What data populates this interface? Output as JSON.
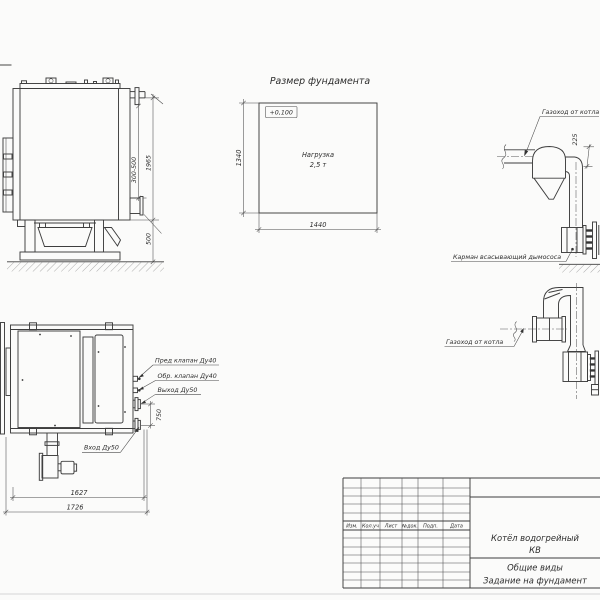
{
  "sheet": {
    "background": "#fbfbfa",
    "line_color": "#3e3e3e",
    "title_block": {
      "columns": [
        "Изм.",
        "Кол.уч",
        "Лист",
        "№док.",
        "Подп.",
        "Дата"
      ],
      "product_line1": "Котёл водогрейный",
      "product_line2": "КВ",
      "doc_line1": "Общие виды",
      "doc_line2": "Задание на фундамент"
    }
  },
  "side_view": {
    "dim_nozzle": "300-500",
    "dim_height": "1965",
    "dim_base": "500"
  },
  "foundation": {
    "title": "Размер фундамента",
    "elevation": "+0,100",
    "load_line1": "Нагрузка",
    "load_line2": "2,5 т",
    "dim_width": "1440",
    "dim_depth": "1340"
  },
  "flue_upper": {
    "label_duct": "Газоход от котла",
    "dim_offset": "225",
    "label_pocket": "Карман всасывающий дымососа"
  },
  "flue_lower": {
    "label_duct": "Газоход от котла"
  },
  "plan_view": {
    "label_safety_valve": "Пред клапан Ду40",
    "label_check_valve": "Обр. клапан Ду40",
    "label_outlet": "Выход Ду50",
    "label_inlet": "Вход Ду50",
    "dim_spacing": "750",
    "dim_inner": "1627",
    "dim_outer": "1726"
  }
}
